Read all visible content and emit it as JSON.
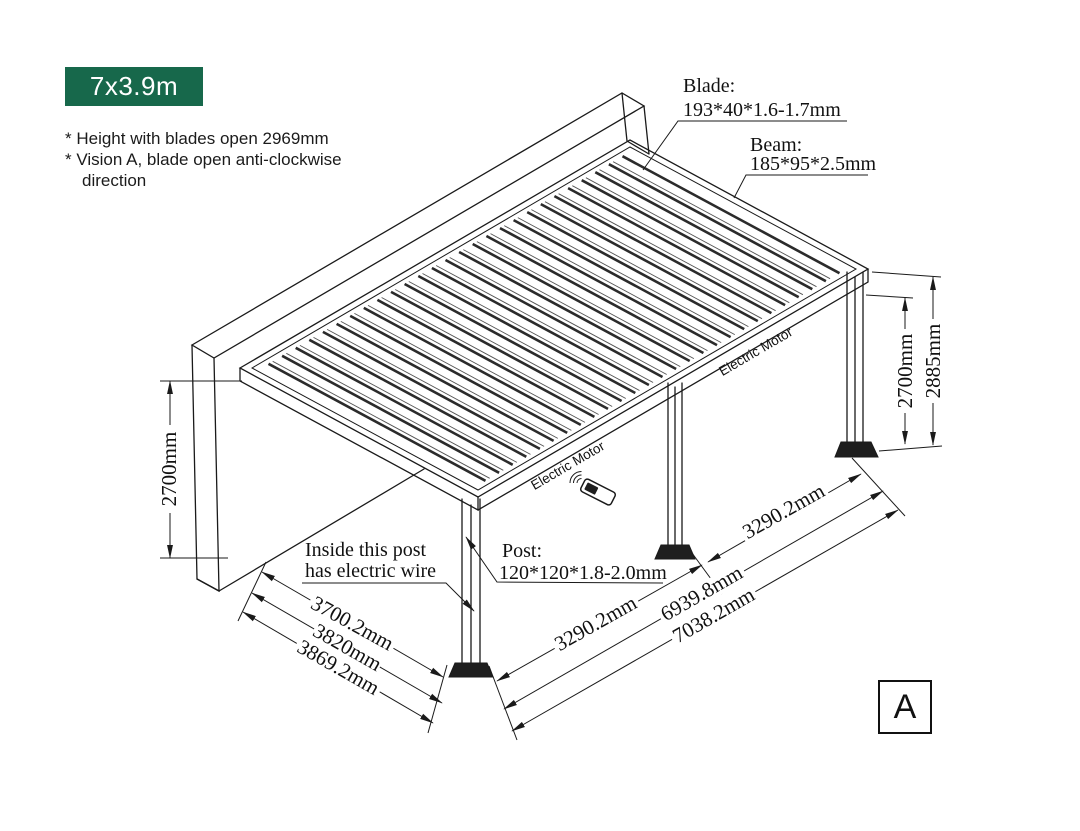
{
  "badge": {
    "label": "7x3.9m",
    "bg": "#17684b",
    "fg": "#ffffff"
  },
  "notes": {
    "line1": "* Height with blades open 2969mm",
    "line2": "* Vision A, blade open anti-clockwise",
    "line3": "direction"
  },
  "callouts": {
    "blade": {
      "title": "Blade:",
      "spec": "193*40*1.6-1.7mm"
    },
    "beam": {
      "title": "Beam:",
      "spec": "185*95*2.5mm"
    },
    "post": {
      "title": "Post:",
      "spec": "120*120*1.8-2.0mm"
    },
    "electric_note": {
      "line1": "Inside this post",
      "line2": "has electric wire"
    }
  },
  "motor_label": "Electric Motor",
  "dimensions": {
    "wall_height": "2700mm",
    "post_height": "2700mm",
    "total_height": "2885mm",
    "depth_inner": "3700.2mm",
    "depth_mid": "3820mm",
    "depth_outer": "3869.2mm",
    "bay_front": "3290.2mm",
    "bay_rear": "3290.2mm",
    "length_posts": "6939.8mm",
    "length_total": "7038.2mm"
  },
  "view_label": "A",
  "colors": {
    "line": "#1a1a1a",
    "badge_green": "#17684b"
  }
}
